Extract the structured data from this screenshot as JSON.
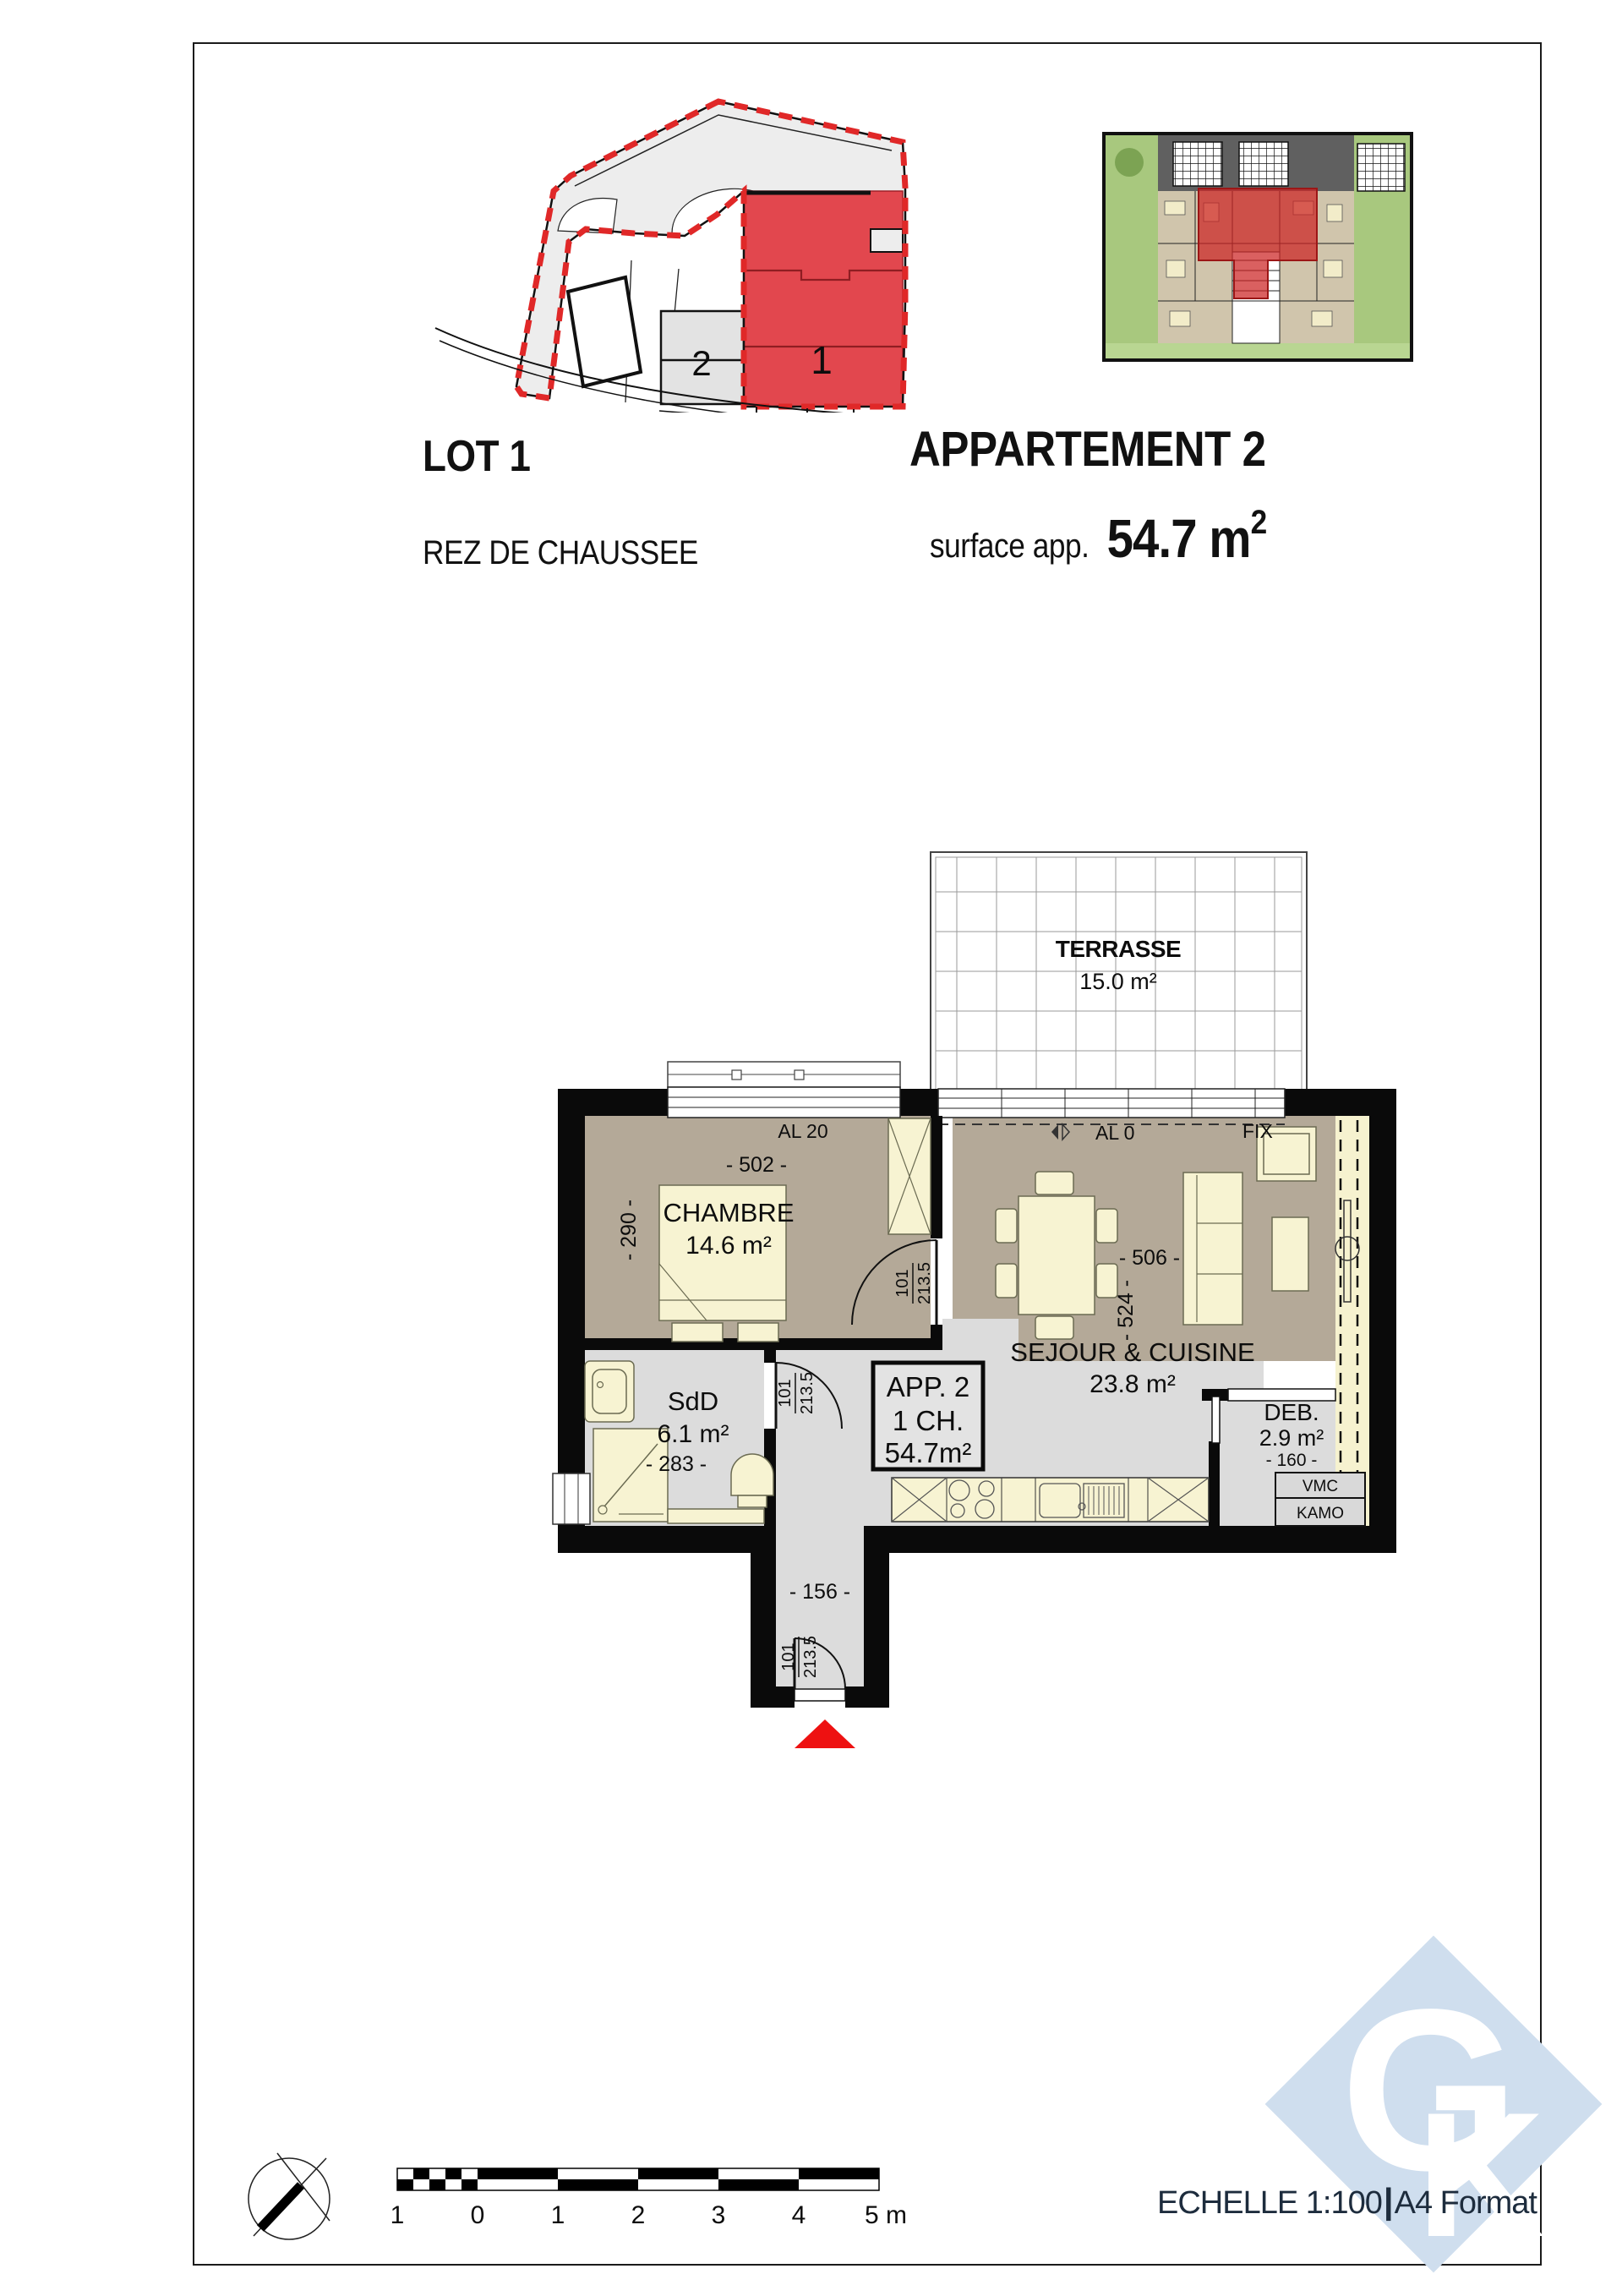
{
  "header": {
    "lot_title": "LOT 1",
    "lot_subtitle": "REZ DE CHAUSSEE",
    "apartment_title": "APPARTEMENT 2",
    "surface_label": "surface app.",
    "surface_value": "54.7 m",
    "surface_sup": "2"
  },
  "site_plan": {
    "building_1": "1",
    "building_2": "2"
  },
  "plan": {
    "terrasse": {
      "name": "TERRASSE",
      "area": "15.0 m²"
    },
    "chambre": {
      "name": "CHAMBRE",
      "area": "14.6 m²",
      "width": "- 502 -",
      "depth": "- 290 -",
      "window": "AL 20"
    },
    "sejour": {
      "name": "SEJOUR & CUISINE",
      "area": "23.8 m²",
      "width": "- 506 -",
      "depth": "- 524 -",
      "window_left": "AL 0",
      "window_right": "FIX"
    },
    "sdd": {
      "name": "SdD",
      "area": "6.1 m²",
      "width": "- 283 -"
    },
    "deb": {
      "name": "DEB.",
      "area": "2.9 m²",
      "width": "- 160 -"
    },
    "hall": {
      "width": "- 156 -"
    },
    "app_box": {
      "line1": "APP. 2",
      "line2": "1 CH.",
      "line3": "54.7m²"
    },
    "door": {
      "w": "101",
      "h": "213.5"
    },
    "tech": {
      "vmc": "VMC",
      "kamo": "KAMO"
    }
  },
  "footer": {
    "scale_text": "ECHELLE 1:100",
    "separator": "|",
    "format_text": "A4 Format",
    "scale_ticks": [
      "1",
      "0",
      "1",
      "2",
      "3",
      "4",
      "5 m"
    ]
  },
  "logo": {
    "letter_g": "G",
    "letter_k": "K"
  }
}
